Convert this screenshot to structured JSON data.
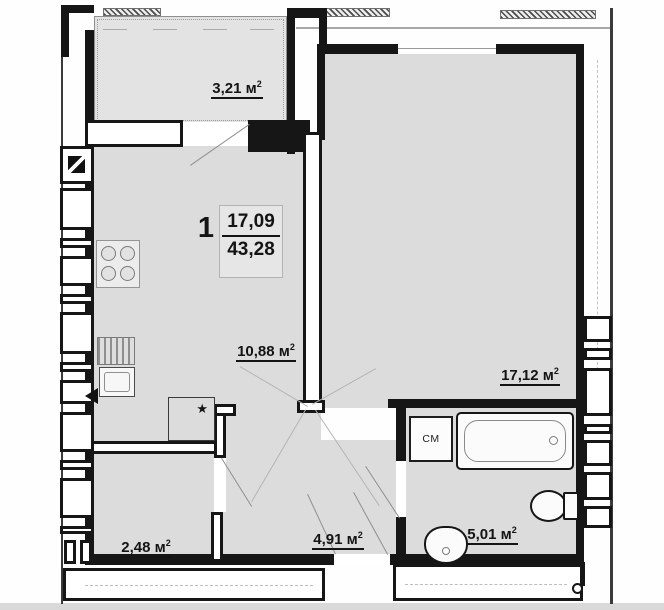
{
  "apartment": {
    "number": "1",
    "living_area": "17,09",
    "total_area": "43,28"
  },
  "rooms": {
    "balcony": {
      "value": "3,21",
      "unit": "м",
      "sup": "2"
    },
    "kitchen": {
      "value": "10,88",
      "unit": "м",
      "sup": "2"
    },
    "living": {
      "value": "17,12",
      "unit": "м",
      "sup": "2"
    },
    "storage": {
      "value": "2,48",
      "unit": "м",
      "sup": "2"
    },
    "hallway": {
      "value": "4,91",
      "unit": "м",
      "sup": "2"
    },
    "bathroom": {
      "value": "5,01",
      "unit": "м",
      "sup": "2"
    }
  },
  "fixtures": {
    "washing_machine": "СМ",
    "closet_marker": "★"
  },
  "colors": {
    "wall": "#161616",
    "room_fill": "#dcdcdc",
    "balcony_fill": "#e3e3e3",
    "background": "#fefefe",
    "swing_line": "#8f8f8f"
  }
}
